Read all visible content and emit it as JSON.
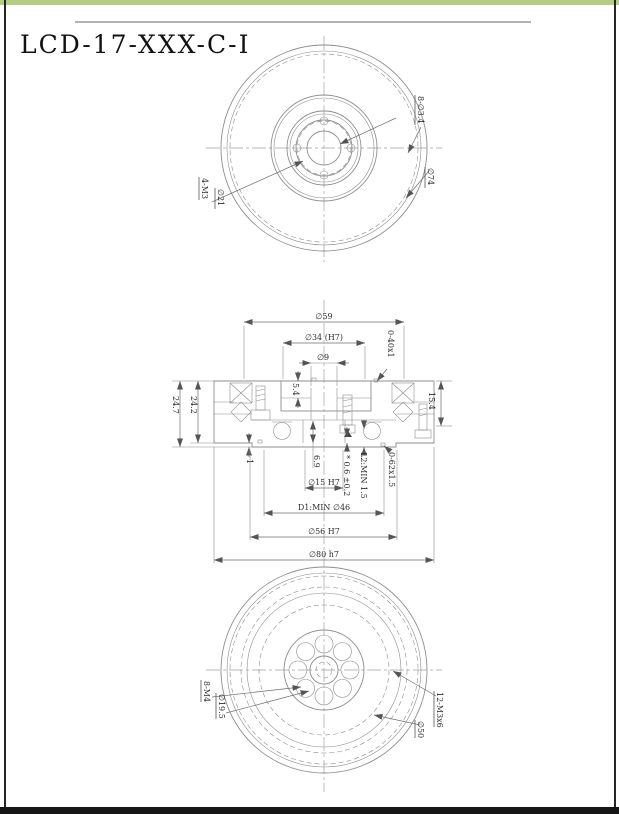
{
  "page": {
    "title": "LCD-17-XXX-C-I"
  },
  "colors": {
    "accent_green": "#b5cc85",
    "footer_black": "#161616",
    "line_gray": "#8e8e8e"
  },
  "front": {
    "holes": "8-∅3.4",
    "bolt_circle": "∅74",
    "screws": "4-M3",
    "screw_circle": "∅21"
  },
  "section": {
    "d59": "∅59",
    "d34": "∅34 (H7)",
    "d9": "∅9",
    "s54": "5.4",
    "oring_top": "0-40x1",
    "s154": "15.4",
    "s247": "24.7",
    "s242": "24.2",
    "s1": "1",
    "s69": "6.9",
    "tol": "* 0.6 ±0.2",
    "l2": "L2:MIN 1.5",
    "oring_bottom": "0-62x1.5",
    "d15": "∅15 H7",
    "d46": "D1:MIN ∅46",
    "d56": "∅56 H7",
    "d80": "∅80 h7"
  },
  "back": {
    "m4": "8-M4",
    "d195": "∅19.5",
    "m3": "12-M3x6",
    "d50": "∅50"
  }
}
